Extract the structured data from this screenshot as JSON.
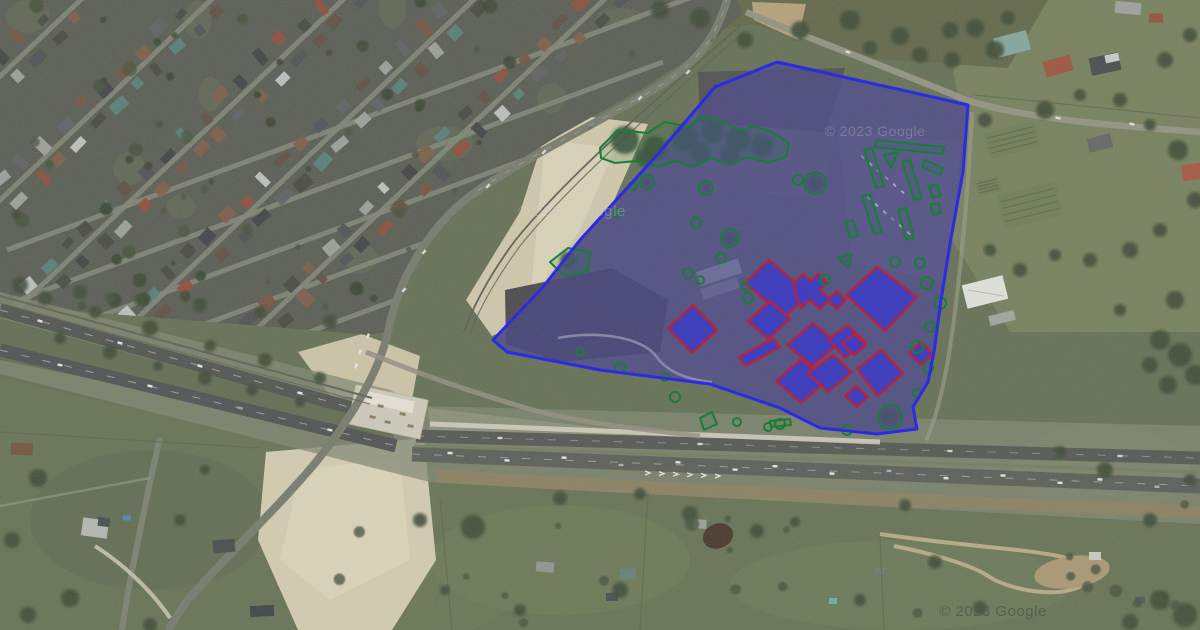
{
  "map": {
    "attribution": "© 2023 Google",
    "watermarks": [
      {
        "text": "© 2023 Google",
        "x": 875,
        "y": 136,
        "size": 14,
        "color": "#b6b6ca",
        "opacity": 0.36
      },
      {
        "text": "© 2023 Google",
        "x": 993,
        "y": 616,
        "size": 15,
        "color": "#525e4d",
        "opacity": 0.9
      },
      {
        "text": "© 2023 Google",
        "x": 572,
        "y": 216,
        "size": 15,
        "color": "#ced3d9",
        "opacity": 0.32
      }
    ]
  },
  "overlays": {
    "colors": {
      "site_stroke": "#2b2be4",
      "site_fill": "#4f4fd4",
      "site_fill_opacity": 0.3,
      "building_stroke": "#b5243f",
      "building_fill": "#3d3dc4",
      "building_fill_opacity": 0.88,
      "tree_stroke": "#1b7c3a"
    },
    "site_boundary": {
      "points": "777,62 968,105 963,172 951,238 941,300 934,352 928,382 913,407 917,429 877,434 820,428 780,408 710,384 600,370 507,352 493,340 543,287 580,240 657,155 715,87"
    },
    "buildings": [
      "668,328 693,305 717,330 692,353",
      "745,283 769,260 809,294 785,317",
      "793,284 803,274 811,281 818,274 827,283 820,290 829,298 837,291 846,300 837,309 828,301 820,309 810,300 801,308",
      "846,295 877,267 917,297 885,331",
      "748,321 770,301 790,319 768,339",
      "739,357 773,338 780,347 746,366",
      "787,345 813,323 838,344 812,366",
      "828,339 848,325 866,343 845,358",
      "776,381 801,359 826,381 801,403",
      "808,373 833,355 852,372 828,392",
      "857,369 881,350 903,373 878,396",
      "845,396 856,386 868,397 857,407",
      "842,344 854,334 866,345 854,355",
      "909,353 921,342 933,354 921,365"
    ],
    "tree_outlines": {
      "circles": [
        [
          647,
          182,
          7
        ],
        [
          706,
          188,
          7
        ],
        [
          798,
          180,
          5
        ],
        [
          815,
          183,
          11
        ],
        [
          696,
          223,
          5
        ],
        [
          730,
          238,
          9
        ],
        [
          721,
          258,
          5
        ],
        [
          688,
          273,
          5
        ],
        [
          700,
          280,
          4
        ],
        [
          745,
          286,
          4
        ],
        [
          748,
          298,
          5
        ],
        [
          825,
          280,
          5
        ],
        [
          895,
          262,
          5
        ],
        [
          920,
          263,
          5
        ],
        [
          927,
          283,
          6
        ],
        [
          940,
          303,
          6
        ],
        [
          930,
          327,
          5
        ],
        [
          917,
          347,
          6
        ],
        [
          928,
          368,
          5
        ],
        [
          917,
          393,
          4
        ],
        [
          890,
          417,
          12
        ],
        [
          847,
          430,
          5
        ],
        [
          780,
          424,
          5
        ],
        [
          768,
          427,
          4
        ],
        [
          737,
          422,
          4
        ],
        [
          675,
          397,
          5
        ],
        [
          665,
          377,
          4
        ],
        [
          620,
          368,
          5
        ],
        [
          580,
          352,
          4
        ],
        [
          617,
          213,
          4
        ],
        [
          633,
          186,
          4
        ]
      ],
      "polygons": [
        "600,148 618,130 648,133 664,122 690,127 700,117 724,121 740,131 754,126 772,132 789,143 786,157 768,163 748,157 729,165 711,158 693,167 676,161 657,167 636,161 615,163 601,158",
        "550,262 568,248 590,252 588,271 565,277",
        "700,418 712,412 717,424 704,430",
        "884,155 898,152 891,168",
        "838,258 852,254 848,268",
        "770,421 790,419 791,425 771,427",
        "876,140 944,147 943,154 875,147",
        "864,150 872,148 884,186 876,188",
        "902,162 910,160 922,198 914,200",
        "925,160 943,168 940,175 922,167",
        "862,196 870,194 882,232 874,234",
        "898,210 906,208 914,238 906,240",
        "929,186 937,184 941,196 933,198",
        "930,205 938,203 941,213 933,215",
        "845,222 853,220 858,236 850,238"
      ]
    }
  }
}
